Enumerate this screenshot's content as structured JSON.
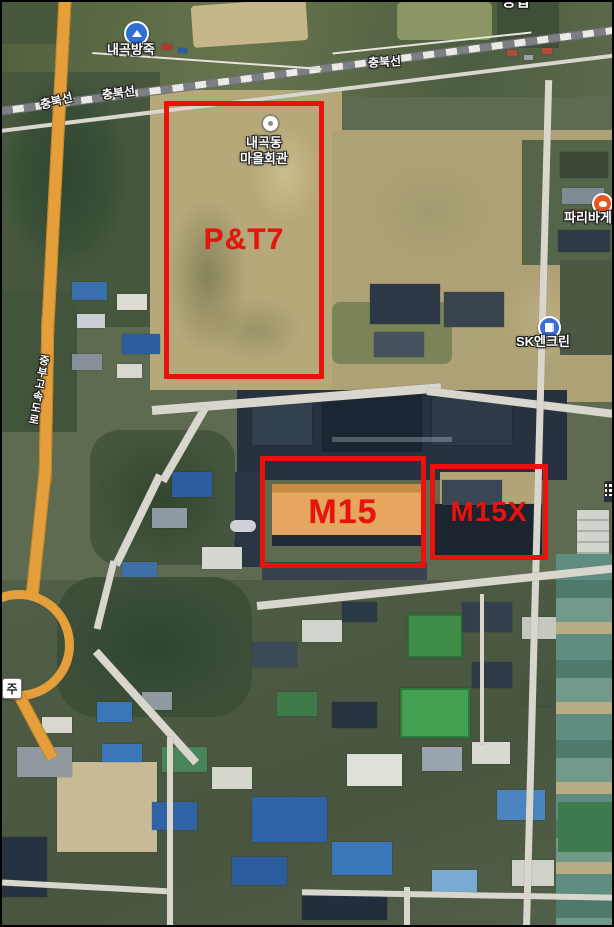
{
  "image_type": "annotated satellite map",
  "labels": {
    "reservoir": "내곡방죽",
    "railway_line": "충북선",
    "village_hall_line1": "내곡동",
    "village_hall_line2": "마을회관",
    "bakery_partial": "파리바게",
    "gas_station": "SK엔크린",
    "expressway": "중부고속도로",
    "left_edge_partial": "주",
    "top_edge_partial": "증업"
  },
  "annotations": {
    "color": "#e8130d",
    "items": [
      {
        "id": "pt7",
        "label": "P&T7"
      },
      {
        "id": "m15",
        "label": "M15"
      },
      {
        "id": "m15x",
        "label": "M15X"
      }
    ]
  },
  "markers": {
    "reservoir_icon": "water-place-marker",
    "village_hall_icon": "village-hall-dot-marker",
    "bakery_icon": "paris-baguette-marker",
    "gas_icon": "gas-station-marker",
    "right_edge_icon": "clipped-poi-marker"
  },
  "colors": {
    "annotation_red": "#e8130d",
    "m15_roof_orange": "#e6a65f",
    "expressway_orange": "#e59f3a",
    "reservoir_marker_blue": "#2f6fd6",
    "gas_marker_blue": "#3d6ed6",
    "bakery_marker_orange": "#e8571c"
  }
}
